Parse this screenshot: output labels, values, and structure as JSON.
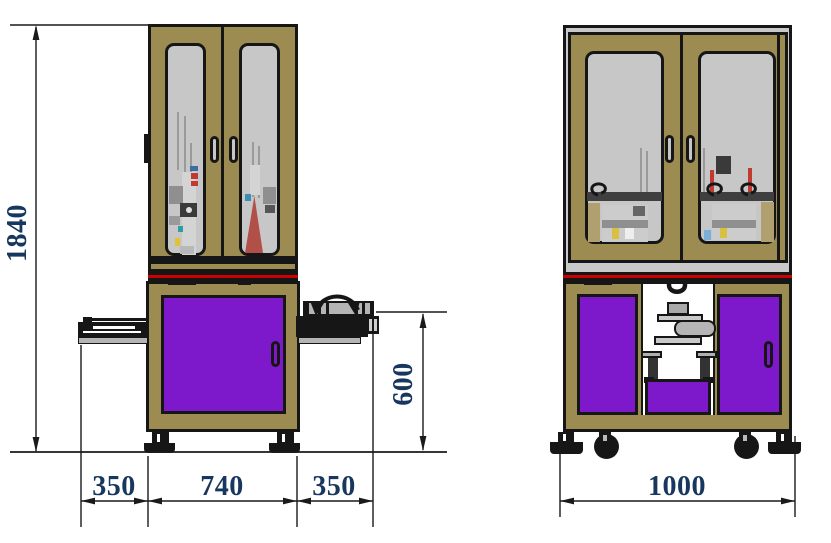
{
  "drawing": {
    "type": "machine-outline-dimension-drawing",
    "front": {
      "height": "1840",
      "bottom_widths": [
        "350",
        "740",
        "350"
      ],
      "table_height": "600"
    },
    "side": {
      "width": "1000"
    }
  },
  "colors": {
    "frame_tan": "#9c8c52",
    "panel_purple": "#7d19cb",
    "glass_gray": "#c7c7c7",
    "outer_frame_gray": "#c9c9c9",
    "accent_red": "#cc0000",
    "dimension_text": "#17375e",
    "line": "#1a1a1a"
  }
}
